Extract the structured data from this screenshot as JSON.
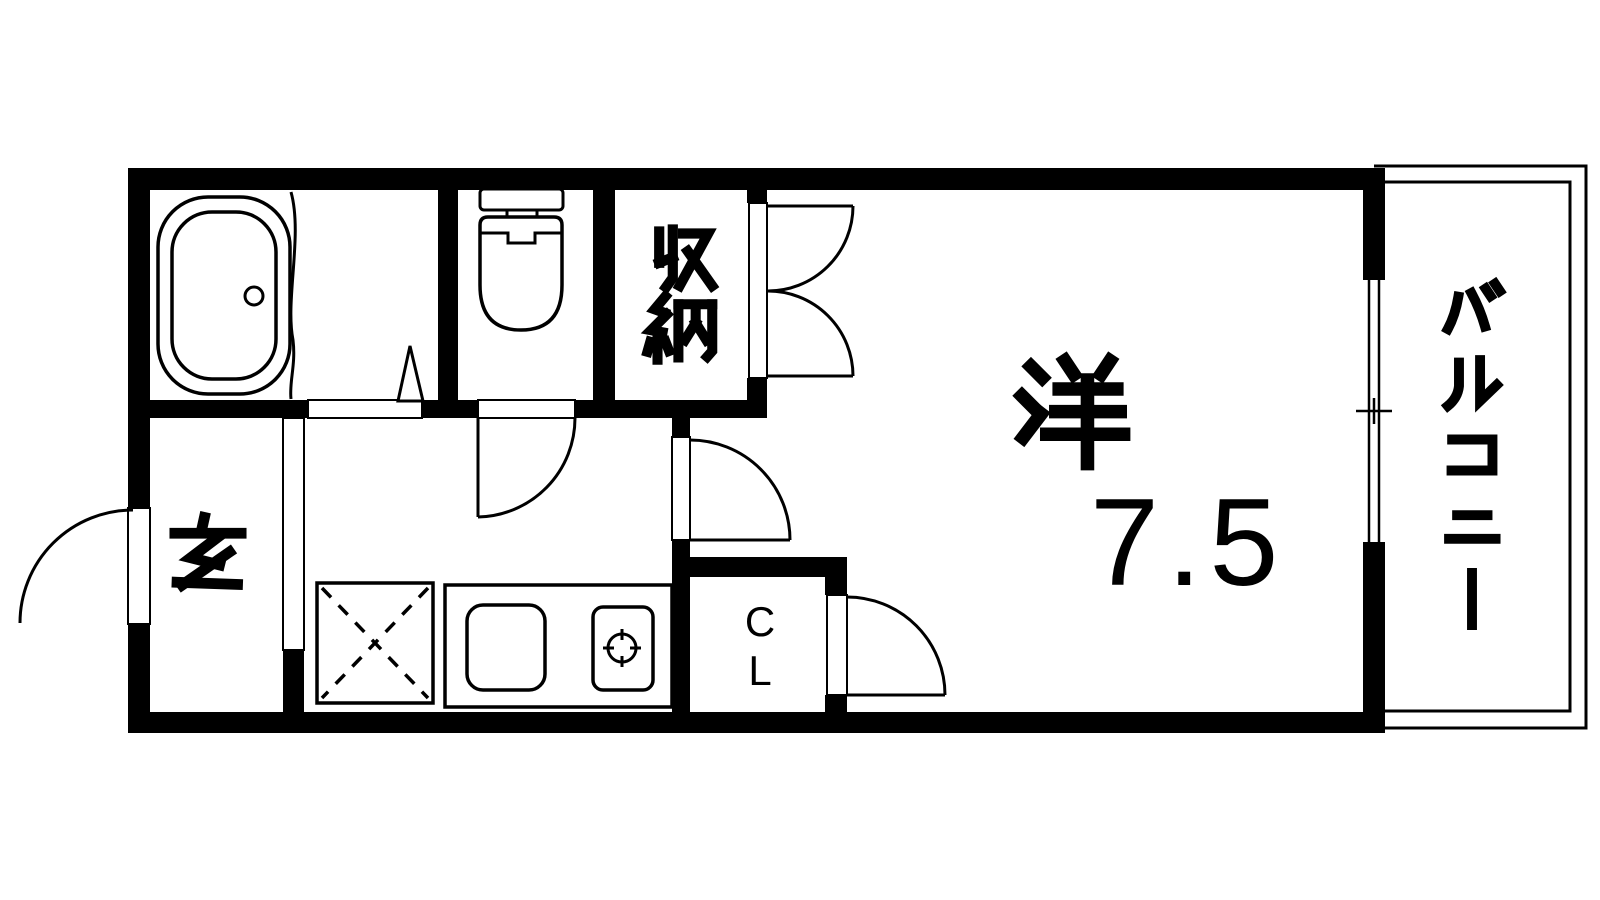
{
  "floor_plan": {
    "background_color": "#ffffff",
    "line_color": "#000000",
    "labels": {
      "entrance": "玄",
      "storage": "収納",
      "western_room": "洋",
      "western_room_size": "7.5",
      "closet": "CL",
      "balcony": "バルコニー"
    },
    "icons": {
      "bathtub": "bathtub-icon",
      "toilet": "toilet-icon",
      "kitchen_sink": "kitchen-sink-icon",
      "stove_burner": "stove-burner-icon",
      "refrigerator_space": "refrigerator-x-icon",
      "window": "sliding-window-icon",
      "door_swing": "door-swing-icon"
    }
  }
}
